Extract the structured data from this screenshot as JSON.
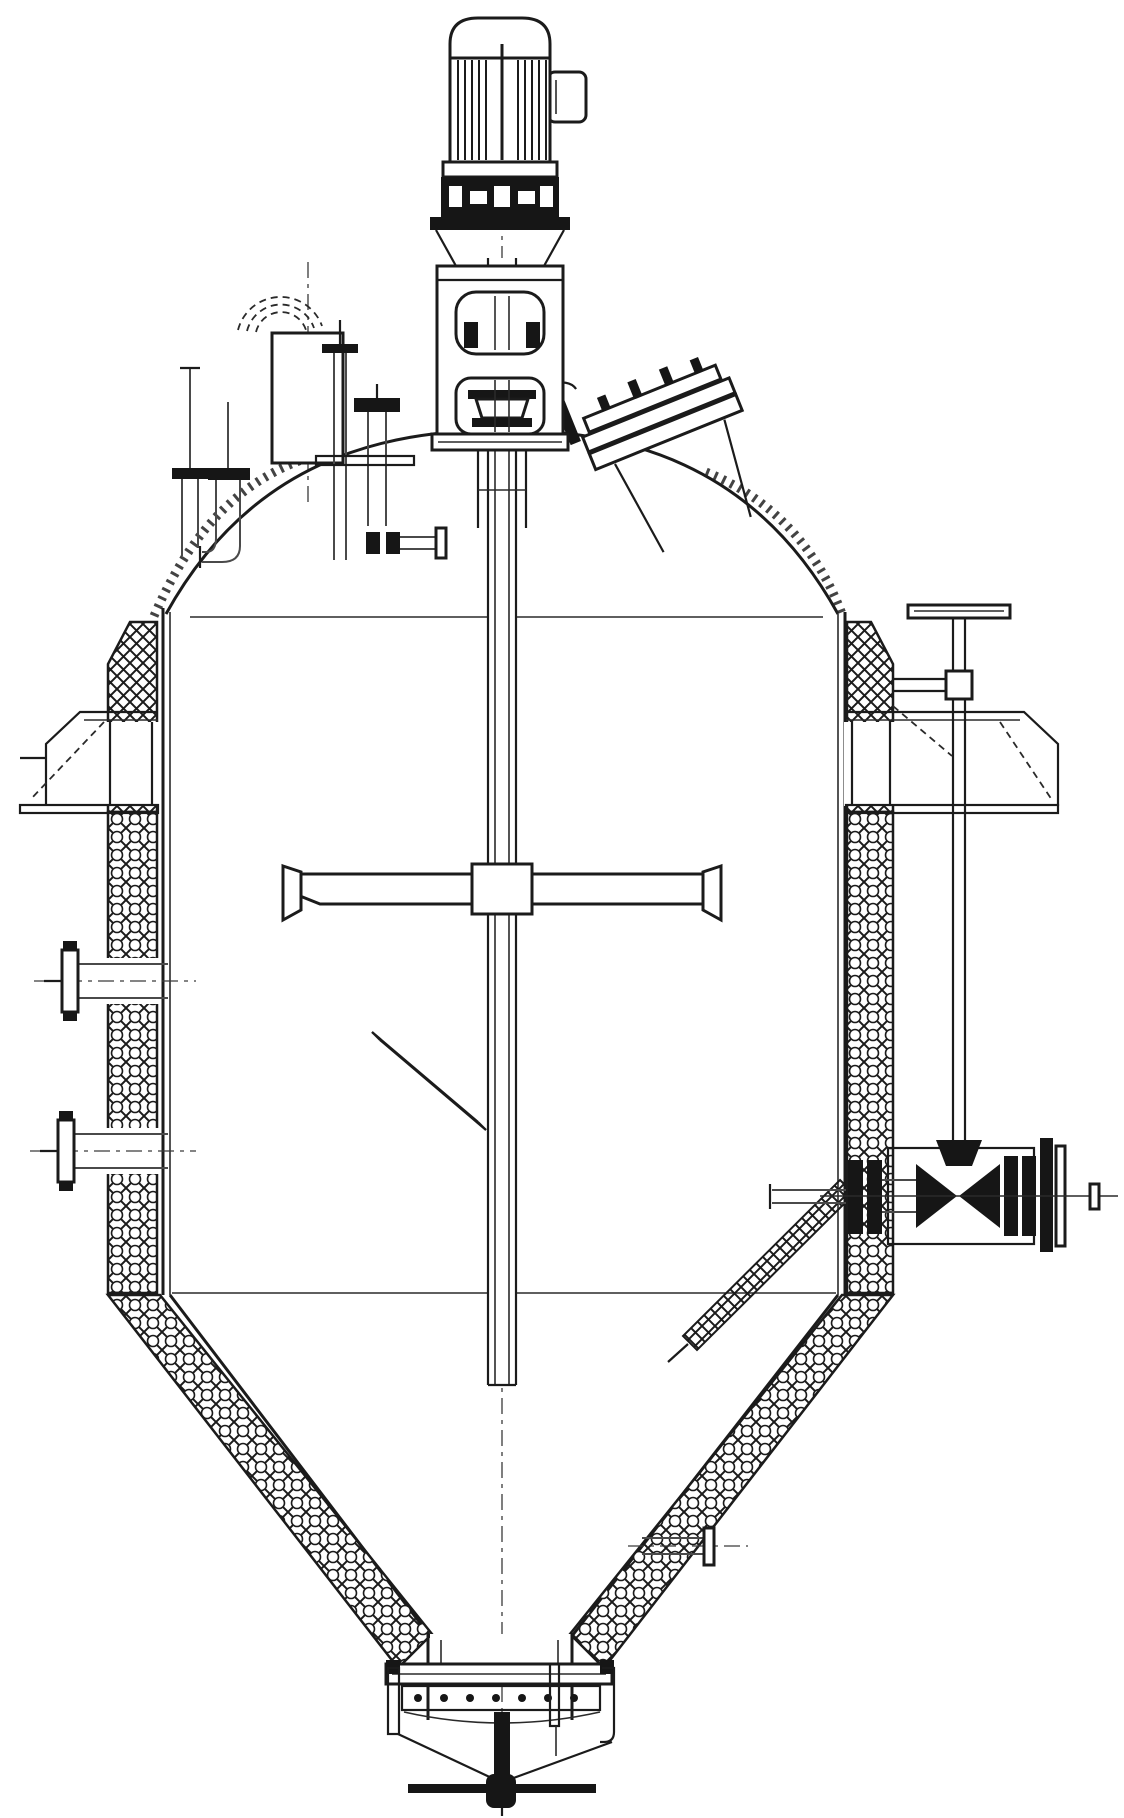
{
  "drawing": {
    "background_color": "#ffffff",
    "line_color": "#1b1b1b",
    "type": "engineering line drawing, agitated reactor vessel elevation, monochrome, no text"
  },
  "components": {
    "drive_motor": "drive-motor",
    "motor_terminal_box": "motor-terminal-box",
    "motor_coupling_guard": "motor-coupling-guard",
    "agitator_lantern": "agitator-lantern-stand",
    "mechanical_seal": "mechanical-seal",
    "agitator_shaft": "agitator-shaft",
    "shaft_centerline": "shaft-centerline",
    "vessel_head": "vessel-top-head",
    "head_insulation": "head-insulation",
    "vent_nozzle": "small-vent-nozzle",
    "elbow_nozzle": "elbow-drain-nozzle",
    "breather_block": "breather-block",
    "gooseneck": "gooseneck-vent",
    "thermowell": "thermowell-pipe",
    "t_flange_nozzle": "t-flange-nozzle",
    "flush_stub": "seal-flush-stub",
    "manway": "inclined-manway",
    "standpipe": "valve-extension-standpipe",
    "standpipe_bracket": "standpipe-support-bracket",
    "shell": "vessel-shell",
    "insulation_left": "wall-insulation-left",
    "insulation_right": "wall-insulation-right",
    "lug_left": "support-lug-left",
    "lug_right": "support-lug-right",
    "tangent_top": "top-tangent-line",
    "tangent_bottom": "bottom-tangent-line",
    "nozzle_left_upper": "side-nozzle-left-upper",
    "nozzle_left_lower": "side-nozzle-left-lower",
    "paddle": "paddle-agitator-arm",
    "pitched_blade": "pitched-bottom-blade",
    "cone": "conical-bottom",
    "cone_jacket": "cone-halfcoil-jacket",
    "dip_pipe": "inclined-dip-pipe",
    "side_valve": "side-outlet-valve",
    "cone_nozzle": "cone-side-nozzle",
    "outlet_neck": "bottom-outlet-neck",
    "discharge_valve": "bottom-discharge-valve"
  }
}
